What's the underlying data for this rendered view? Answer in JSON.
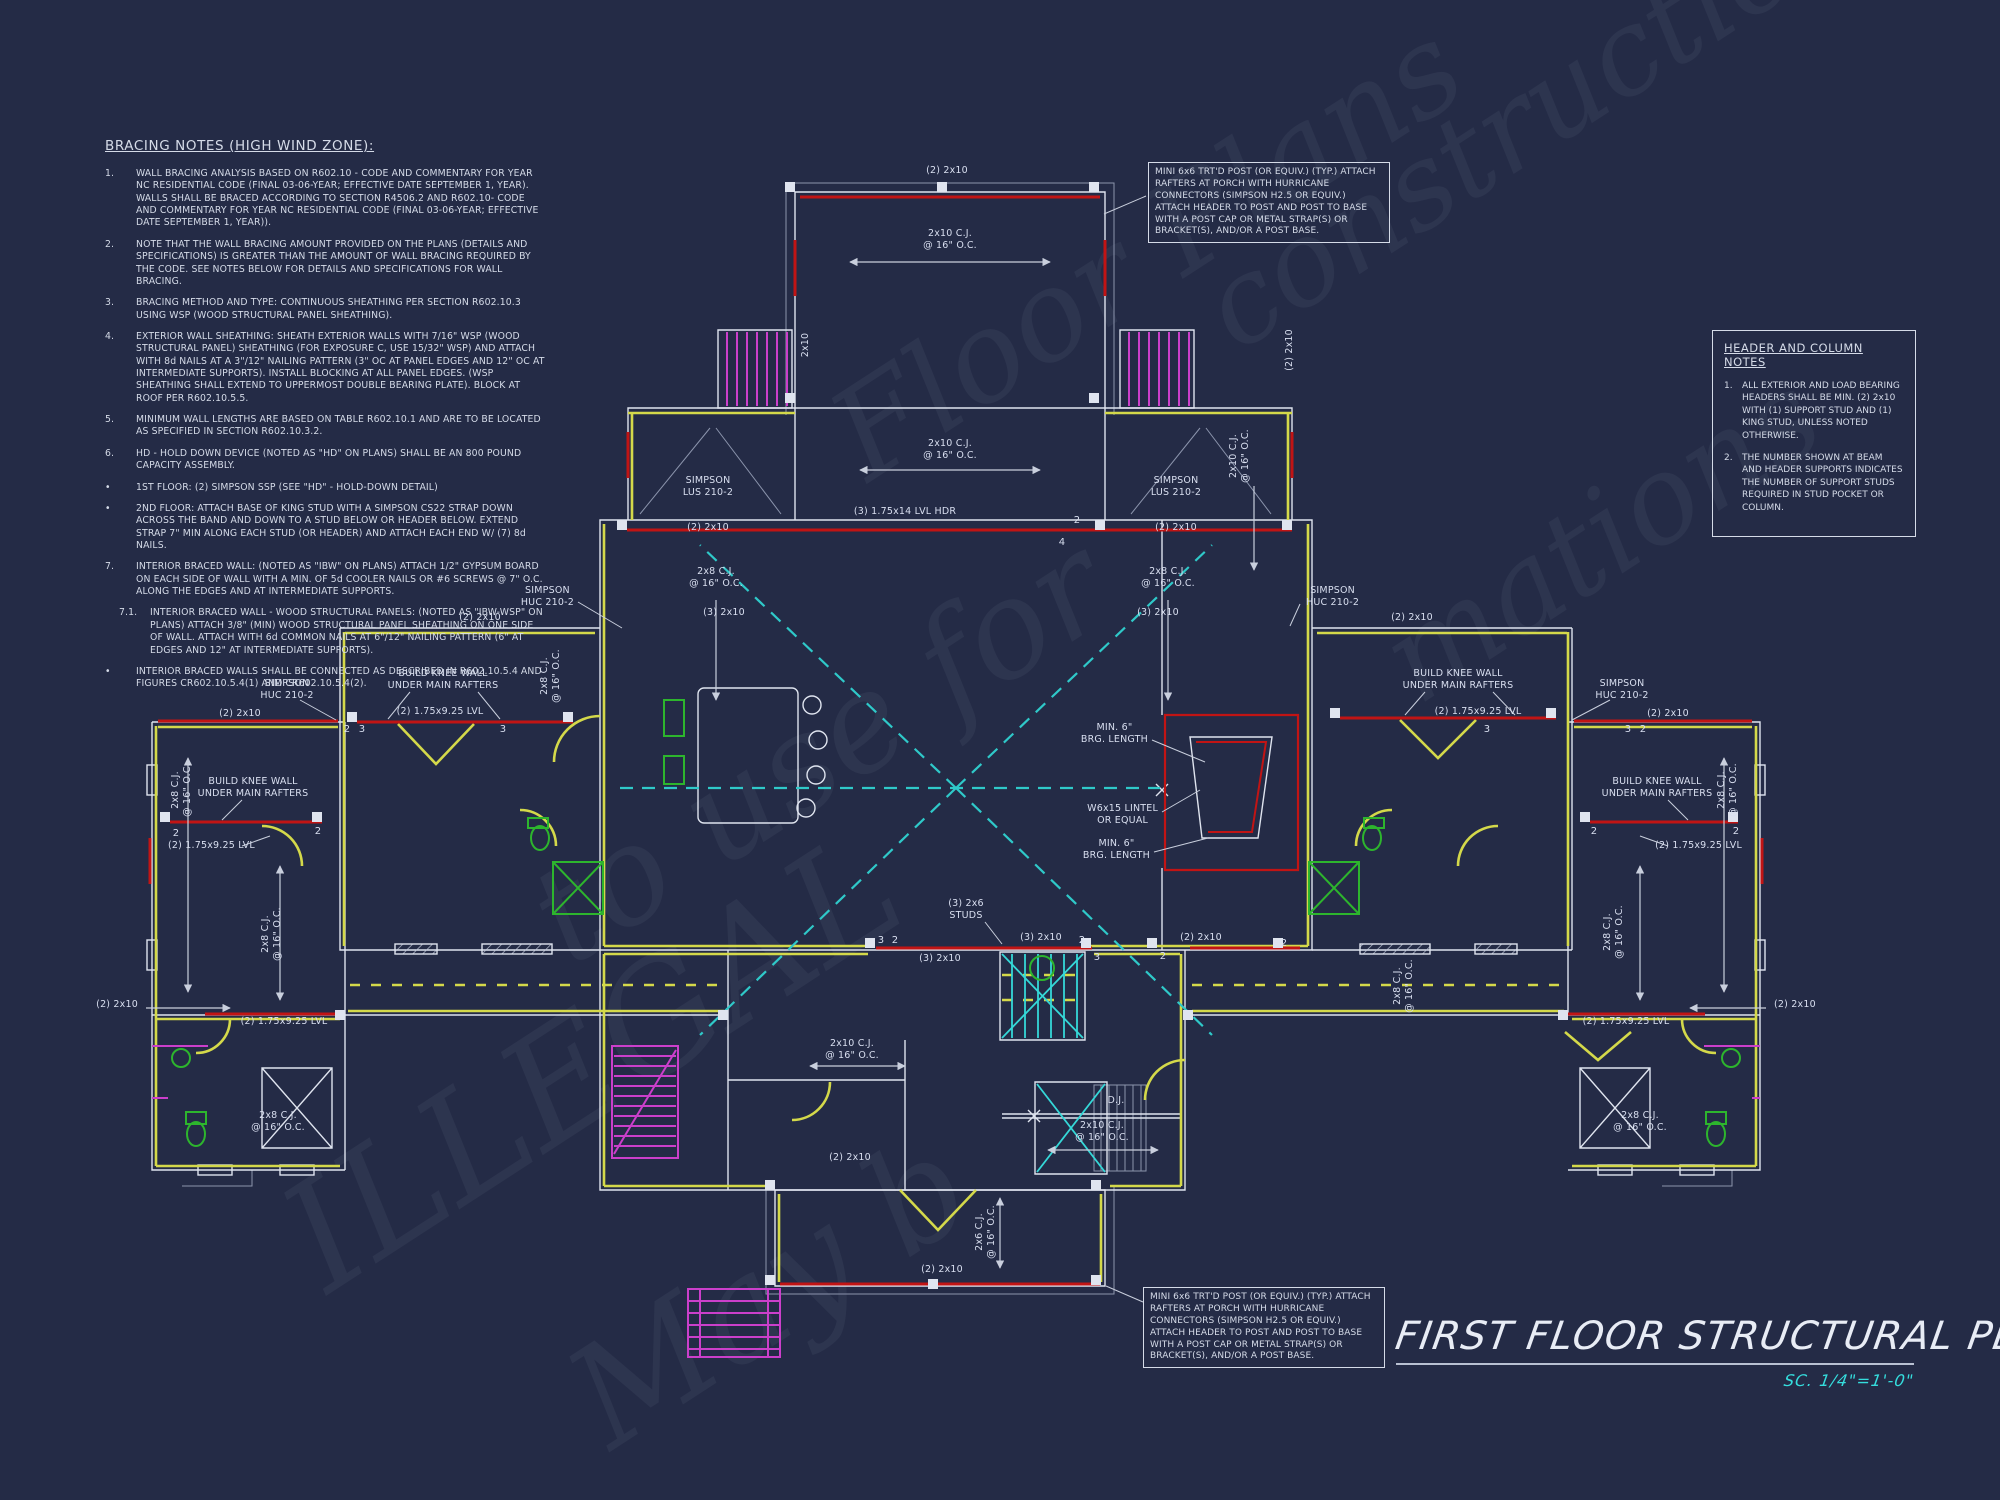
{
  "colors": {
    "background": "#242b46",
    "line_white": "#dfe4ef",
    "wall_yellow": "#d4d94a",
    "beam_red": "#c11414",
    "stair_magenta": "#cb3fcb",
    "framing_cyan": "#2fc9c9",
    "fixture_green": "#2db52d",
    "scale_cyan": "#35dddd"
  },
  "bracing_notes": {
    "title": "BRACING NOTES (HIGH WIND ZONE):",
    "items": [
      {
        "num": "1.",
        "text": "WALL BRACING ANALYSIS BASED ON R602.10 - CODE AND COMMENTARY FOR YEAR NC RESIDENTIAL CODE (FINAL 03-06-YEAR; EFFECTIVE DATE SEPTEMBER 1, YEAR). WALLS SHALL BE BRACED ACCORDING TO SECTION R4506.2 AND R602.10- CODE AND COMMENTARY FOR YEAR NC RESIDENTIAL CODE (FINAL 03-06-YEAR; EFFECTIVE DATE SEPTEMBER 1, YEAR))."
      },
      {
        "num": "2.",
        "text": "NOTE THAT THE WALL BRACING AMOUNT PROVIDED ON THE PLANS (DETAILS AND SPECIFICATIONS) IS GREATER THAN THE AMOUNT OF WALL BRACING REQUIRED BY THE CODE. SEE NOTES BELOW FOR DETAILS AND SPECIFICATIONS FOR WALL BRACING."
      },
      {
        "num": "3.",
        "text": "BRACING METHOD AND TYPE: CONTINUOUS SHEATHING PER SECTION R602.10.3 USING WSP (WOOD STRUCTURAL PANEL SHEATHING)."
      },
      {
        "num": "4.",
        "text": "EXTERIOR WALL SHEATHING: SHEATH EXTERIOR WALLS WITH 7/16\" WSP (WOOD STRUCTURAL PANEL) SHEATHING (FOR EXPOSURE C, USE 15/32\" WSP) AND ATTACH WITH 8d NAILS AT A 3\"/12\" NAILING PATTERN (3\" OC AT PANEL EDGES AND 12\" OC AT INTERMEDIATE SUPPORTS). INSTALL BLOCKING AT ALL PANEL EDGES. (WSP SHEATHING SHALL EXTEND TO UPPERMOST DOUBLE BEARING PLATE). BLOCK AT ROOF PER R602.10.5.5."
      },
      {
        "num": "5.",
        "text": "MINIMUM WALL LENGTHS ARE BASED ON TABLE R602.10.1 AND ARE TO BE LOCATED AS SPECIFIED IN SECTION R602.10.3.2."
      },
      {
        "num": "6.",
        "text": "HD - HOLD DOWN DEVICE (NOTED AS \"HD\" ON PLANS) SHALL BE AN 800 POUND CAPACITY ASSEMBLY."
      },
      {
        "num": "•",
        "text": "1ST FLOOR: (2) SIMPSON SSP (SEE \"HD\" - HOLD-DOWN DETAIL)"
      },
      {
        "num": "•",
        "text": "2ND FLOOR: ATTACH BASE OF KING STUD WITH A SIMPSON CS22 STRAP DOWN ACROSS THE BAND AND DOWN TO A STUD BELOW OR HEADER BELOW.  EXTEND STRAP 7\" MIN ALONG EACH STUD (OR HEADER) AND ATTACH EACH END W/ (7) 8d NAILS."
      },
      {
        "num": "7.",
        "text": "INTERIOR BRACED WALL: (NOTED AS \"IBW\" ON PLANS) ATTACH 1/2\" GYPSUM BOARD ON EACH SIDE OF WALL WITH A MIN. OF 5d COOLER NAILS OR #6 SCREWS @ 7\" O.C. ALONG THE EDGES AND AT INTERMEDIATE SUPPORTS."
      },
      {
        "num": "7.1.",
        "ind": 1,
        "text": "INTERIOR BRACED WALL - WOOD STRUCTURAL PANELS: (NOTED AS \"IBW-WSP\" ON PLANS) ATTACH 3/8\" (MIN) WOOD STRUCTURAL PANEL SHEATHING ON ONE SIDE OF WALL. ATTACH WITH 6d COMMON NAILS AT 6\"/12\" NAILING PATTERN (6\" AT EDGES AND 12\" AT INTERMEDIATE SUPPORTS)."
      },
      {
        "num": "•",
        "text": "INTERIOR BRACED WALLS SHALL BE CONNECTED AS DESCRIBED IN R602.10.5.4 AND FIGURES CR602.10.5.4(1) AND CR602.10.5.4(2)."
      }
    ]
  },
  "header_column_notes": {
    "title": "HEADER AND COLUMN NOTES",
    "items": [
      {
        "num": "1.",
        "text": "ALL EXTERIOR AND LOAD BEARING HEADERS SHALL BE MIN. (2) 2x10 WITH (1) SUPPORT STUD AND (1) KING STUD, UNLESS NOTED OTHERWISE."
      },
      {
        "num": "2.",
        "text": "THE NUMBER SHOWN AT BEAM AND HEADER SUPPORTS INDICATES THE NUMBER OF SUPPORT STUDS REQUIRED IN STUD POCKET OR COLUMN."
      }
    ]
  },
  "post_callout": {
    "text": "MINI 6x6 TRT'D POST (OR EQUIV.) (TYP.) ATTACH RAFTERS AT PORCH WITH HURRICANE CONNECTORS (SIMPSON H2.5 OR EQUIV.) ATTACH HEADER TO POST AND POST TO BASE WITH A POST CAP OR METAL STRAP(S) OR BRACKET(S), AND/OR A POST BASE."
  },
  "title_block": {
    "title": "FIRST FLOOR STRUCTURAL PLAN",
    "scale": "SC. 1/4\"=1'-0\""
  },
  "watermark": {
    "fragments": [
      {
        "t": "ILLEGAL",
        "x": 300,
        "y": 1165,
        "fs": 150
      },
      {
        "t": "to use for",
        "x": 545,
        "y": 850,
        "fs": 135
      },
      {
        "t": "Floor Plans",
        "x": 845,
        "y": 375,
        "fs": 125
      },
      {
        "t": "construction",
        "x": 1215,
        "y": 250,
        "fs": 118
      },
      {
        "t": "May b",
        "x": 585,
        "y": 1330,
        "fs": 140
      },
      {
        "t": "mations",
        "x": 1395,
        "y": 600,
        "fs": 122
      }
    ]
  },
  "plan": {
    "labels": [
      {
        "t": "(2) 2x10",
        "x": 947,
        "y": 171
      },
      {
        "t": "2x10 C.J.\n@ 16\" O.C.",
        "x": 950,
        "y": 240
      },
      {
        "t": "2x10",
        "x": 806,
        "y": 345,
        "r": -90
      },
      {
        "t": "(2) 2x10",
        "x": 1290,
        "y": 350,
        "r": -90
      },
      {
        "t": "2x8 C.J.\n@ 16\" O.C.",
        "x": 551,
        "y": 676,
        "r": -90
      },
      {
        "t": "2x10 C.J.\n@ 16\" O.C.",
        "x": 1240,
        "y": 456,
        "r": -90
      },
      {
        "t": "2x10 C.J.\n@ 16\" O.C.",
        "x": 950,
        "y": 450
      },
      {
        "t": "(3) 1.75x14  LVL HDR",
        "x": 905,
        "y": 512
      },
      {
        "t": "SIMPSON\nLUS 210-2",
        "x": 708,
        "y": 487
      },
      {
        "t": "(2) 2x10",
        "x": 708,
        "y": 528
      },
      {
        "t": "SIMPSON\nLUS 210-2",
        "x": 1176,
        "y": 487
      },
      {
        "t": "(2) 2x10",
        "x": 1176,
        "y": 528
      },
      {
        "t": "2x8 C.J.\n@ 16\" O.C.",
        "x": 716,
        "y": 578
      },
      {
        "t": "2x8 C.J.\n@ 16\" O.C.",
        "x": 1168,
        "y": 578
      },
      {
        "t": "SIMPSON\nHUC 210-2",
        "x": 574,
        "y": 597,
        "a": "e"
      },
      {
        "t": "(3) 2x10",
        "x": 724,
        "y": 613
      },
      {
        "t": "(3) 2x10",
        "x": 1158,
        "y": 613
      },
      {
        "t": "SIMPSON\nHUC 210-2",
        "x": 1306,
        "y": 597,
        "a": "s"
      },
      {
        "t": "(2) 2x10",
        "x": 480,
        "y": 618
      },
      {
        "t": "(2) 2x10",
        "x": 1412,
        "y": 618
      },
      {
        "t": "BUILD KNEE WALL\nUNDER MAIN RAFTERS",
        "x": 443,
        "y": 680
      },
      {
        "t": "BUILD KNEE WALL\nUNDER MAIN RAFTERS",
        "x": 1458,
        "y": 680
      },
      {
        "t": "(2) 1.75x9.25 LVL",
        "x": 440,
        "y": 712
      },
      {
        "t": "(2) 1.75x9.25 LVL",
        "x": 1478,
        "y": 712
      },
      {
        "t": "SIMPSON\nHUC 210-2",
        "x": 287,
        "y": 690
      },
      {
        "t": "SIMPSON\nHUC 210-2",
        "x": 1622,
        "y": 690
      },
      {
        "t": "(2) 2x10",
        "x": 240,
        "y": 714
      },
      {
        "t": "(2) 2x10",
        "x": 1668,
        "y": 714
      },
      {
        "t": "2x8 C.J.\n@ 16\" O.C.",
        "x": 182,
        "y": 790,
        "r": -90
      },
      {
        "t": "2x8 C.J.\n@ 16\" O.C.",
        "x": 1728,
        "y": 790,
        "r": -90
      },
      {
        "t": "BUILD KNEE WALL\nUNDER MAIN RAFTERS",
        "x": 253,
        "y": 788
      },
      {
        "t": "BUILD KNEE WALL\nUNDER MAIN RAFTERS",
        "x": 1657,
        "y": 788
      },
      {
        "t": "(2) 1.75x9.25 LVL",
        "x": 168,
        "y": 846,
        "a": "s"
      },
      {
        "t": "(2) 1.75x9.25 LVL",
        "x": 1742,
        "y": 846,
        "a": "e"
      },
      {
        "t": "2x8 C.J.\n@ 16\" O.C.",
        "x": 272,
        "y": 934,
        "r": -90
      },
      {
        "t": "2x8 C.J.\n@ 16\" O.C.",
        "x": 1404,
        "y": 986,
        "r": -90
      },
      {
        "t": "2x8 C.J.\n@ 16\" O.C.",
        "x": 1614,
        "y": 932,
        "r": -90
      },
      {
        "t": "MIN. 6\"\nBRG. LENGTH",
        "x": 1148,
        "y": 734,
        "a": "e"
      },
      {
        "t": "W6x15 LINTEL\nOR EQUAL",
        "x": 1158,
        "y": 815,
        "a": "e"
      },
      {
        "t": "MIN. 6\"\nBRG. LENGTH",
        "x": 1150,
        "y": 850,
        "a": "e"
      },
      {
        "t": "(3) 2x6\nSTUDS",
        "x": 966,
        "y": 910
      },
      {
        "t": "(3) 2x10",
        "x": 940,
        "y": 959
      },
      {
        "t": "(3) 2x10",
        "x": 1041,
        "y": 938
      },
      {
        "t": "(2) 2x10",
        "x": 1201,
        "y": 938
      },
      {
        "t": "D.J.",
        "x": 1116,
        "y": 1101
      },
      {
        "t": "2x10 C.J.\n@ 16\" O.C.",
        "x": 1102,
        "y": 1132
      },
      {
        "t": "2x10 C.J.\n@ 16\" O.C.",
        "x": 852,
        "y": 1050
      },
      {
        "t": "2x6 C.J.\n@ 16\" O.C.",
        "x": 986,
        "y": 1232,
        "r": -90
      },
      {
        "t": "(2) 2x10",
        "x": 942,
        "y": 1270
      },
      {
        "t": "(2) 2x10",
        "x": 138,
        "y": 1005,
        "a": "e"
      },
      {
        "t": "(2) 1.75x9.25 LVL",
        "x": 284,
        "y": 1022
      },
      {
        "t": "(2) 2x10",
        "x": 1774,
        "y": 1005,
        "a": "s"
      },
      {
        "t": "(2) 1.75x9.25 LVL",
        "x": 1626,
        "y": 1022
      },
      {
        "t": "2x8 C.J.\n@ 16\" O.C.",
        "x": 278,
        "y": 1122
      },
      {
        "t": "2x8 C.J.\n@ 16\" O.C.",
        "x": 1640,
        "y": 1122
      },
      {
        "t": "(2) 2x10",
        "x": 850,
        "y": 1158
      },
      {
        "t": "2",
        "x": 1077,
        "y": 521,
        "fs": 10
      },
      {
        "t": "4",
        "x": 1062,
        "y": 543,
        "fs": 10
      },
      {
        "t": "2",
        "x": 347,
        "y": 730,
        "fs": 10
      },
      {
        "t": "3",
        "x": 362,
        "y": 730,
        "fs": 10
      },
      {
        "t": "3",
        "x": 503,
        "y": 730,
        "fs": 10
      },
      {
        "t": "2",
        "x": 176,
        "y": 834,
        "fs": 10
      },
      {
        "t": "2",
        "x": 318,
        "y": 832,
        "fs": 10
      },
      {
        "t": "2",
        "x": 1643,
        "y": 730,
        "fs": 10
      },
      {
        "t": "3",
        "x": 1628,
        "y": 730,
        "fs": 10
      },
      {
        "t": "3",
        "x": 1487,
        "y": 730,
        "fs": 10
      },
      {
        "t": "2",
        "x": 1736,
        "y": 832,
        "fs": 10
      },
      {
        "t": "2",
        "x": 1594,
        "y": 832,
        "fs": 10
      },
      {
        "t": "3",
        "x": 881,
        "y": 941,
        "fs": 10
      },
      {
        "t": "2",
        "x": 895,
        "y": 941,
        "fs": 10
      },
      {
        "t": "2",
        "x": 1082,
        "y": 941,
        "fs": 10
      },
      {
        "t": "3",
        "x": 1097,
        "y": 958,
        "fs": 10
      },
      {
        "t": "2",
        "x": 1163,
        "y": 957,
        "fs": 10
      },
      {
        "t": "2",
        "x": 1284,
        "y": 944,
        "fs": 10
      }
    ]
  }
}
